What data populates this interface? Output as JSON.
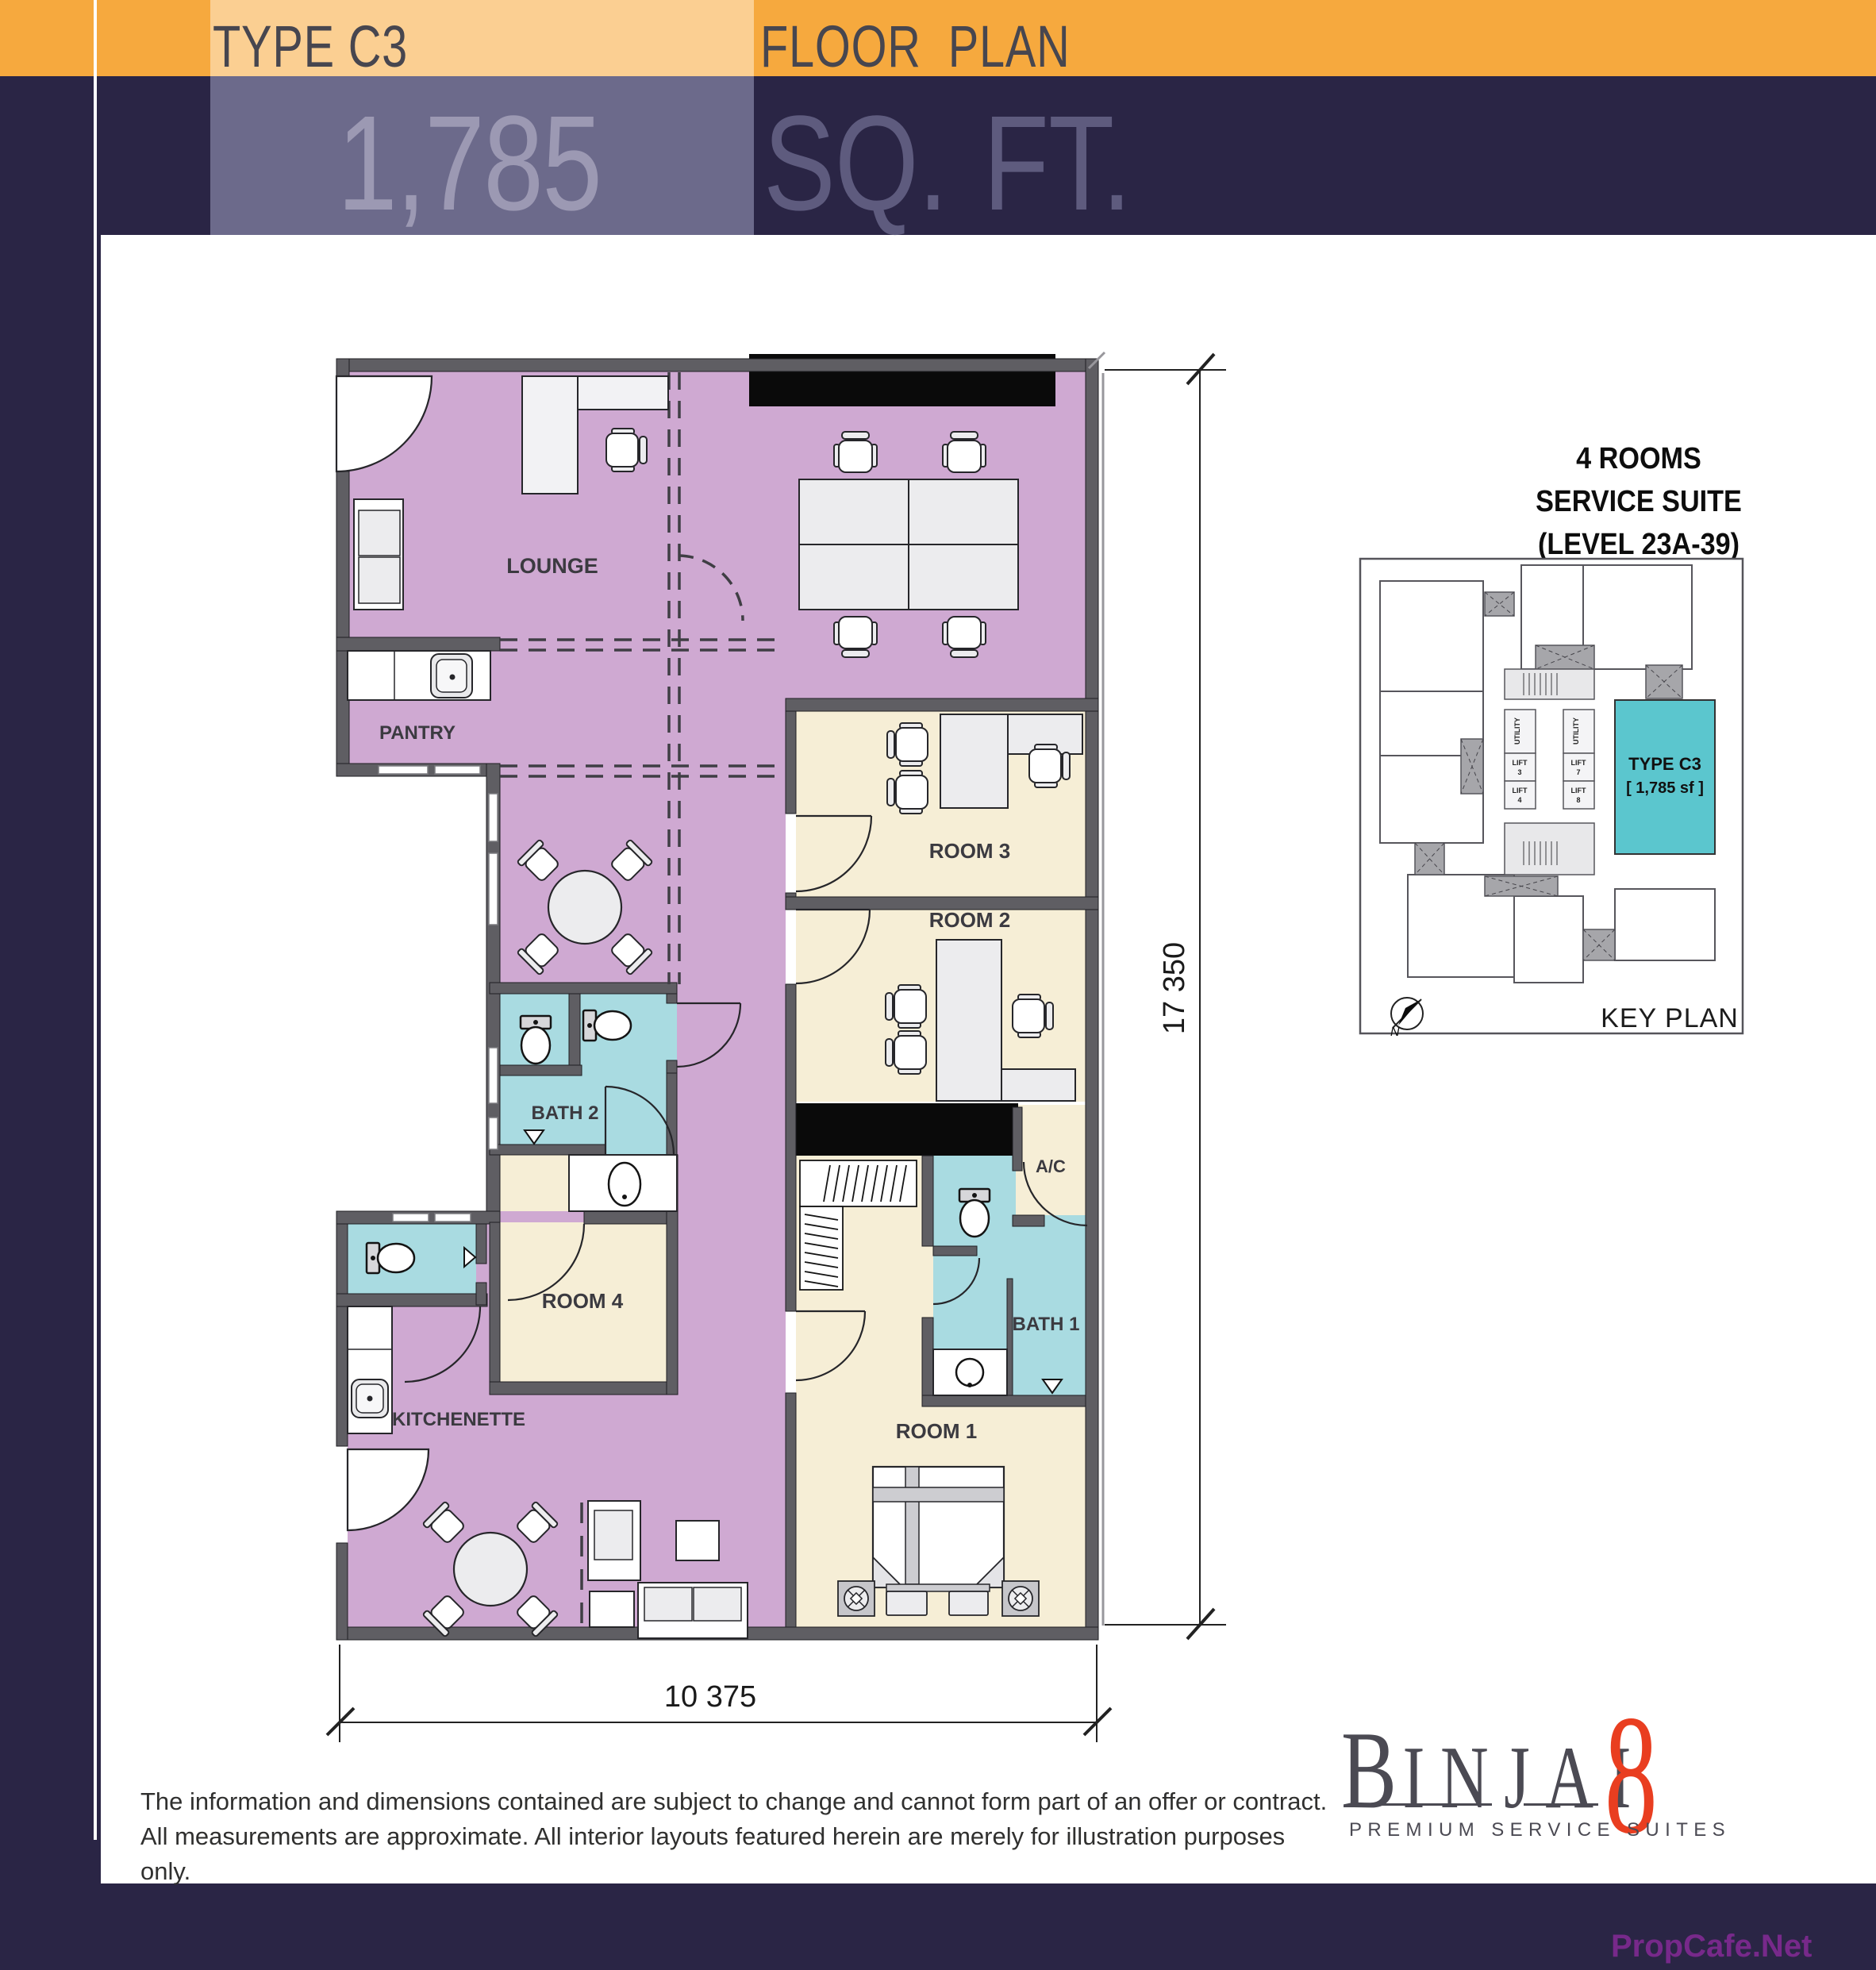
{
  "header": {
    "type_label": "TYPE C3",
    "plan_label": "FLOOR PLAN",
    "area_value": "1,785",
    "area_unit": "SQ. FT."
  },
  "plan": {
    "rooms": {
      "lounge": "LOUNGE",
      "pantry": "PANTRY",
      "room3": "ROOM 3",
      "room2": "ROOM 2",
      "bath2": "BATH 2",
      "ac": "A/C",
      "bath1": "BATH 1",
      "room4": "ROOM 4",
      "kitchenette": "KITCHENETTE",
      "room1": "ROOM 1"
    },
    "dimensions": {
      "height": "17 350",
      "width": "10 375"
    }
  },
  "keyplan": {
    "title_line1": "4 ROOMS",
    "title_line2": "SERVICE SUITE",
    "title_line3": "(LEVEL 23A-39)",
    "unit_label": "TYPE C3",
    "unit_area": "[ 1,785 sf ]",
    "caption": "KEY PLAN",
    "north": "N",
    "utility": "UTILITY",
    "lift": "LIFT",
    "lift_nums": [
      "3",
      "4",
      "7",
      "8"
    ]
  },
  "footer": {
    "disclaimer_line1": "The information and dimensions contained are subject to change and cannot form part of an offer or contract.",
    "disclaimer_line2": "All measurements are approximate. All interior layouts featured herein are merely for illustration purposes only.",
    "watermark": "PropCafe.Net"
  },
  "logo": {
    "first_letter": "B",
    "rest_letters": "INJAI",
    "number": "8",
    "tagline": "PREMIUM SERVICE SUITES"
  },
  "colors": {
    "navy": "#2A2545",
    "navy_light": "#6C6A8B",
    "orange": "#F6A93E",
    "orange_light": "#FBCF92",
    "purple": "#CFA9D2",
    "cream": "#F6EED6",
    "cyan": "#A9DBE1",
    "teal": "#5BC6CE",
    "wall_gray": "#5F5E63",
    "logo_red": "#E93E20",
    "watermark_purple": "#7B2D8C"
  }
}
